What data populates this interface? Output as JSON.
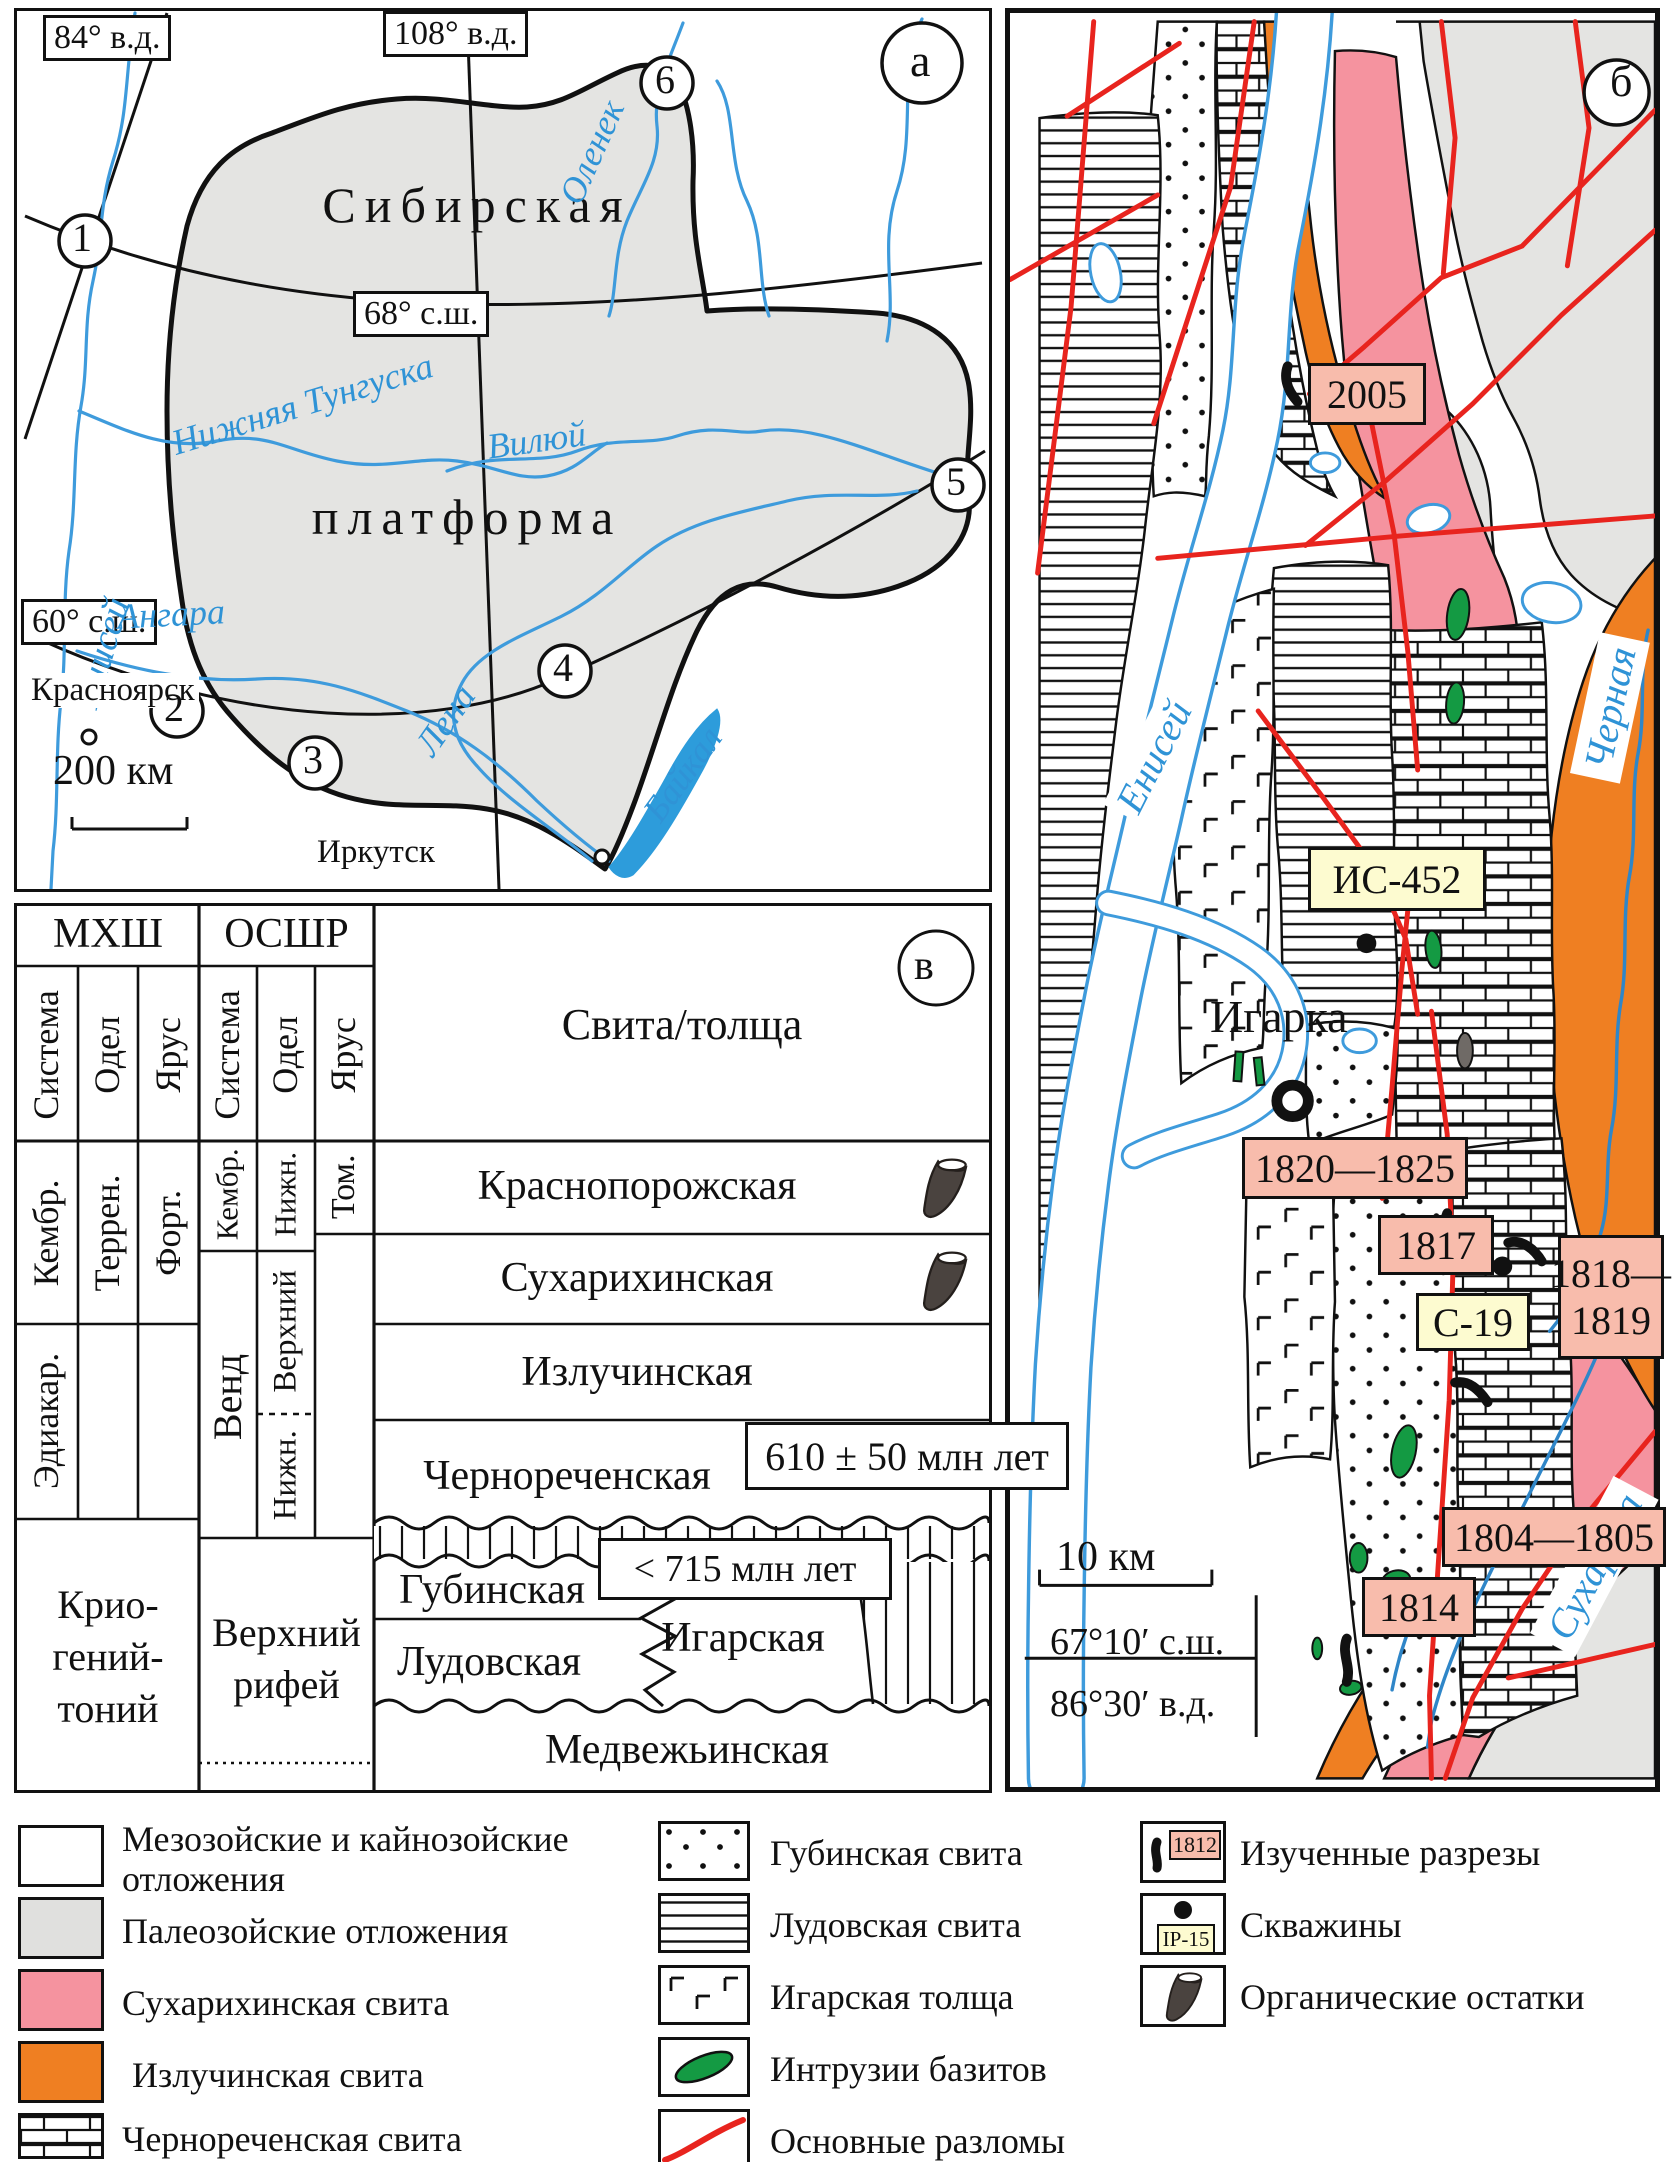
{
  "colors": {
    "paleozoic_gray": "#e4e4e2",
    "sukharikha_pink": "#f5939f",
    "izluchinskaya_orange": "#ef7f22",
    "fault_red": "#e8241e",
    "intrusion_green": "#149a43",
    "river_blue": "#3e9bdc",
    "label_pink": "#f8bcac",
    "label_yellow": "#fdfbd0"
  },
  "panel_a": {
    "tag": "а",
    "labels": {
      "lon84": "84° в.д.",
      "lon108": "108° в.д.",
      "lat68": "68° с.ш.",
      "lat60": "60° с.ш."
    },
    "title1": "Сибирская",
    "title2": "платформа",
    "rivers": {
      "yenisei": "Енисей",
      "olenek": "Оленек",
      "tunguska": "Нижняя Тунгуска",
      "vilyuy": "Вилюй",
      "angara": "Ангара",
      "lena": "Лена",
      "baikal": "Байкал"
    },
    "cities": {
      "krasnoyarsk": "Красноярск",
      "irkutsk": "Иркутск"
    },
    "scale": "200 км",
    "markers": [
      "1",
      "2",
      "3",
      "4",
      "5",
      "6"
    ]
  },
  "panel_b": {
    "tag": "б",
    "town": "Игарка",
    "rivers": {
      "yenisei": "Енисей",
      "chernaya": "Черная",
      "sukharikha": "Сухариха"
    },
    "sections": {
      "s2005": "2005",
      "s1820": "1820—1825",
      "s1817": "1817",
      "s1818a": "1818—",
      "s1818b": "1819",
      "s1804": "1804—1805",
      "s1814": "1814"
    },
    "wells": {
      "is452": "ИС-452",
      "c19": "С-19"
    },
    "scale": "10 км",
    "lat": "67°10′ с.ш.",
    "lon": "86°30′ в.д."
  },
  "panel_v": {
    "tag": "в",
    "scales": {
      "mhsh": "МХШ",
      "osshr": "ОСШР"
    },
    "cols": {
      "system": "Система",
      "otdel": "Одел",
      "yarus": "Ярус"
    },
    "unit_header": "Свита/толща",
    "mhsh": {
      "kembr": "Кембр.",
      "terren": "Террен.",
      "fort": "Форт.",
      "ediakar": "Эдиакар.",
      "cryo1": "Крио-",
      "cryo2": "гений-",
      "cryo3": "тоний"
    },
    "osshr": {
      "kembr": "Кембр.",
      "nizh": "Нижн.",
      "tom": "Том.",
      "vend": "Венд",
      "verkhniy": "Верхний",
      "nizh2": "Нижн.",
      "riph1": "Верхний",
      "riph2": "рифей"
    },
    "units": {
      "krasnoporozhskaya": "Краснопорожская",
      "sukharikhinskaya": "Сухарихинская",
      "izluchinskaya": "Излучинская",
      "chernorechenskaya": "Чернореченская",
      "gubinskaya": "Губинская",
      "ludovskaya": "Лудовская",
      "igarskaya": "Игарская",
      "medvezhinskaya": "Медвежьинская"
    },
    "ages": {
      "chern": "610 ± 50 млн лет",
      "gub": "< 715 млн лет"
    }
  },
  "legend": {
    "col1": [
      {
        "label": "Мезозойские и кайнозойские отложения"
      },
      {
        "label": "Палеозойские отложения"
      },
      {
        "label": "Сухарихинская свита"
      },
      {
        "label": "Излучинская свита"
      },
      {
        "label": "Чернореченская свита"
      }
    ],
    "col2": [
      {
        "label": "Губинская свита"
      },
      {
        "label": "Лудовская свита"
      },
      {
        "label": "Игарская толща"
      },
      {
        "label": "Интрузии базитов"
      },
      {
        "label": "Основные разломы"
      }
    ],
    "col3": [
      {
        "label": "Изученные разрезы",
        "tag": "1812"
      },
      {
        "label": "Скважины",
        "tag": "IP-15"
      },
      {
        "label": "Органические остатки"
      }
    ]
  }
}
